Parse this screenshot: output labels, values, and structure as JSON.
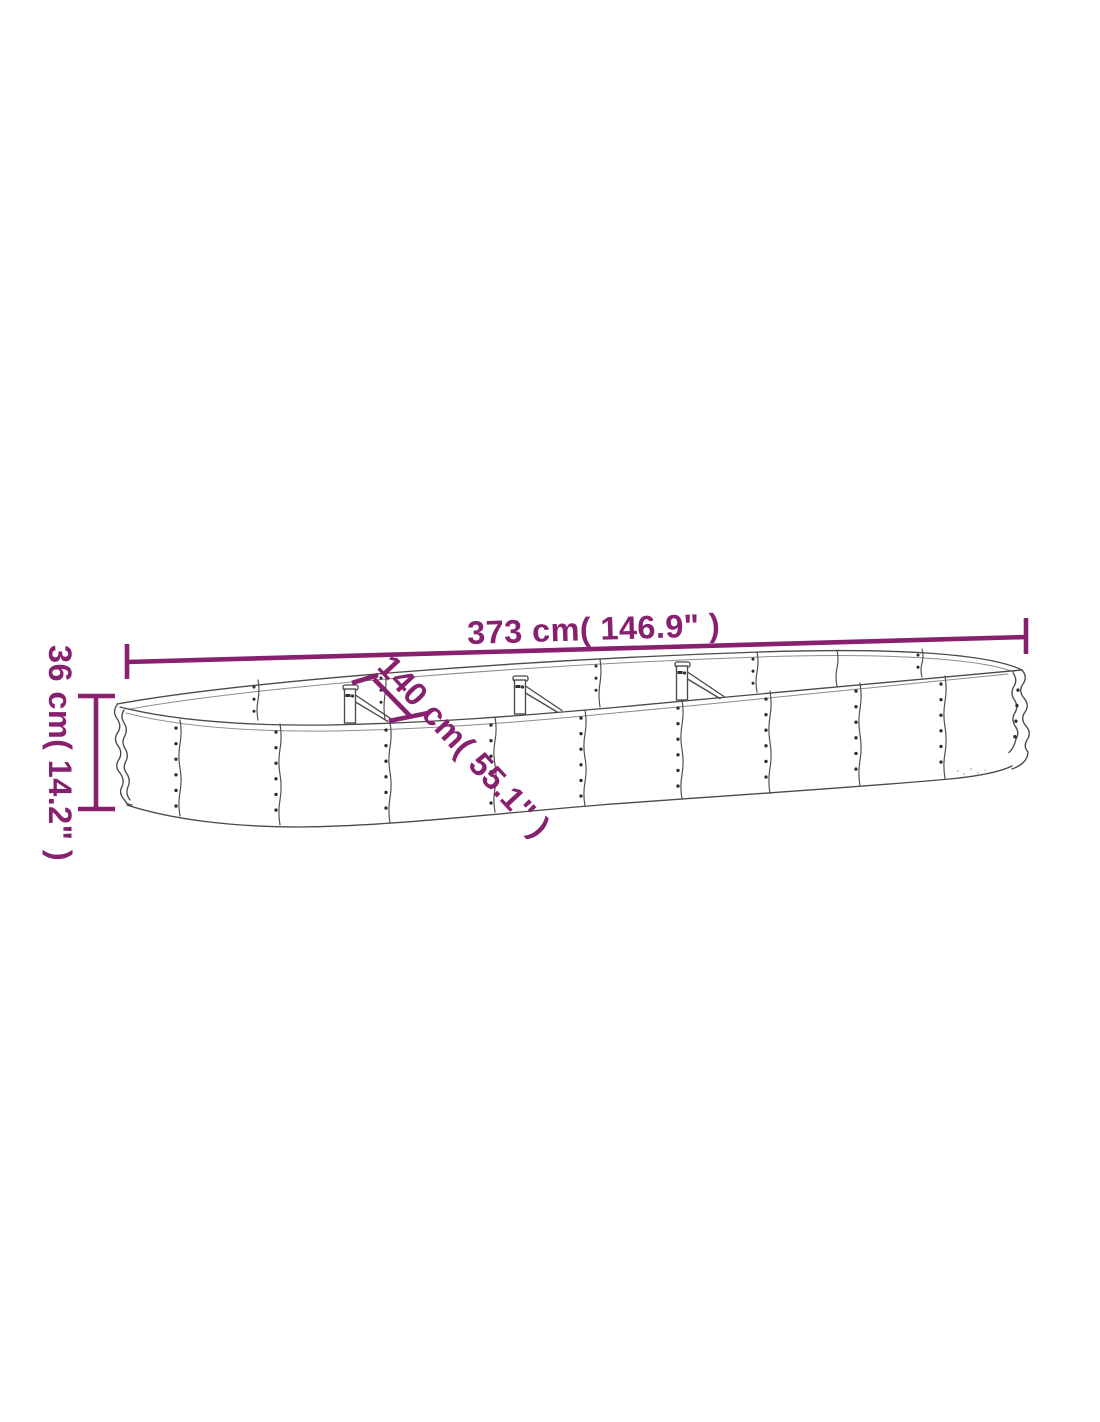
{
  "colors": {
    "dimension_accent": "#86206f",
    "line_art": "#4a4a4a",
    "screw_dots": "#2d2d2d",
    "background": "#ffffff"
  },
  "dimensions": {
    "length": {
      "value_cm": 373,
      "value_in": 146.9,
      "label": "373 cm( 146.9\" )"
    },
    "width": {
      "value_cm": 140,
      "value_in": 55.1,
      "label": "140 cm( 55.1\" )"
    },
    "height": {
      "value_cm": 36,
      "value_in": 14.2,
      "label": "36 cm( 14.2\" )"
    }
  }
}
